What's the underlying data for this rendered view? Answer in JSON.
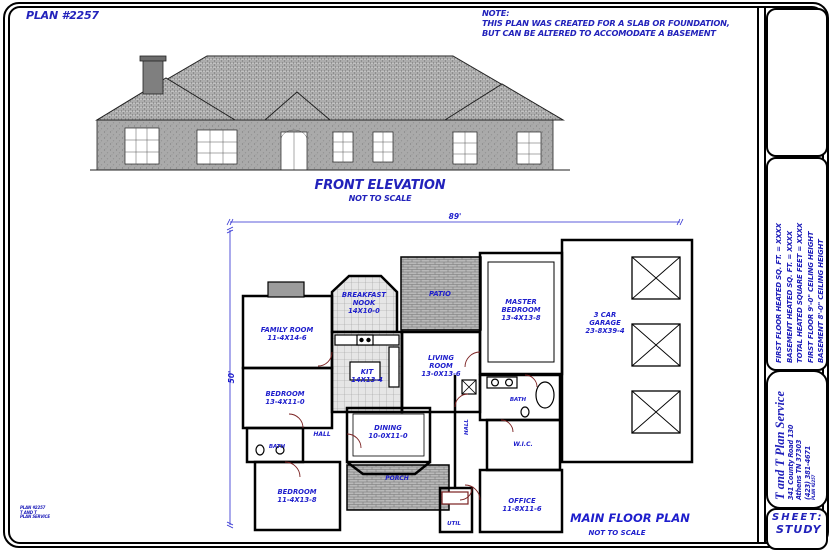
{
  "sheet": {
    "plan_number": "PLAN #2257",
    "note_title": "NOTE:",
    "note_line1": "THIS PLAN WAS CREATED FOR A SLAB OR FOUNDATION,",
    "note_line2": "BUT CAN BE ALTERED TO ACCOMODATE A BASEMENT"
  },
  "elevation": {
    "title": "FRONT ELEVATION",
    "scale": "NOT TO SCALE"
  },
  "floor_plan": {
    "title": "MAIN FLOOR PLAN",
    "scale": "NOT TO SCALE",
    "width_dim": "89'",
    "depth_dim": "50'",
    "rooms": {
      "family": {
        "name": "FAMILY ROOM",
        "size": "11-4X14-6"
      },
      "nook": {
        "line1": "BREAKFAST",
        "line2": "NOOK",
        "size": "14X10-0"
      },
      "kitchen": {
        "name": "KIT",
        "size": "14X13-4"
      },
      "patio": {
        "name": "PATIO"
      },
      "living": {
        "line1": "LIVING",
        "line2": "ROOM",
        "size": "13-0X13-6"
      },
      "master": {
        "line1": "MASTER",
        "line2": "BEDROOM",
        "size": "13-4X13-8"
      },
      "garage": {
        "line1": "3 CAR",
        "line2": "GARAGE",
        "size": "23-8X39-4"
      },
      "bedroom2": {
        "name": "BEDROOM",
        "size": "13-4X11-0"
      },
      "bath2": {
        "name": "BATH"
      },
      "hall": {
        "name": "HALL"
      },
      "dining": {
        "name": "DINING",
        "size": "10-0X11-0"
      },
      "bedroom3": {
        "name": "BEDROOM",
        "size": "11-4X13-8"
      },
      "porch": {
        "name": "PORCH"
      },
      "util": {
        "name": "UTIL"
      },
      "office": {
        "name": "OFFICE",
        "size": "11-8X11-6"
      },
      "wic": {
        "name": "W.I.C."
      },
      "master_bath": {
        "name": "BATH"
      },
      "hall2": {
        "name": "HALL"
      }
    }
  },
  "title_block": {
    "specs": [
      "FIRST FLOOR HEATED SQ. FT. = XXXX",
      "BASEMENT HEATED SQ. FT. = XXXX",
      "TOTAL HEATED SQUARE FEET = XXXX",
      "FIRST FLOOR 9'-0\" CEILING HEIGHT",
      "BASEMENT 8'-0\" CEILING HEIGHT"
    ],
    "company": "T and T Plan Service",
    "address_line1": "341 County Road 130",
    "address_line2": "Athens TN 37303",
    "phone": "(423) 381-4671",
    "plan_ref": "PLAN #2257",
    "sheet_label": "SHEET:",
    "sheet_name": "STUDY"
  },
  "corner_stamp": {
    "line1": "PLAN #2257",
    "line2": "T AND T",
    "line3": "PLAN SERVICE"
  },
  "colors": {
    "ink": "#2222bb",
    "wall": "#000000",
    "roof_gray": "#c2c2c2",
    "body_gray": "#adadad"
  }
}
